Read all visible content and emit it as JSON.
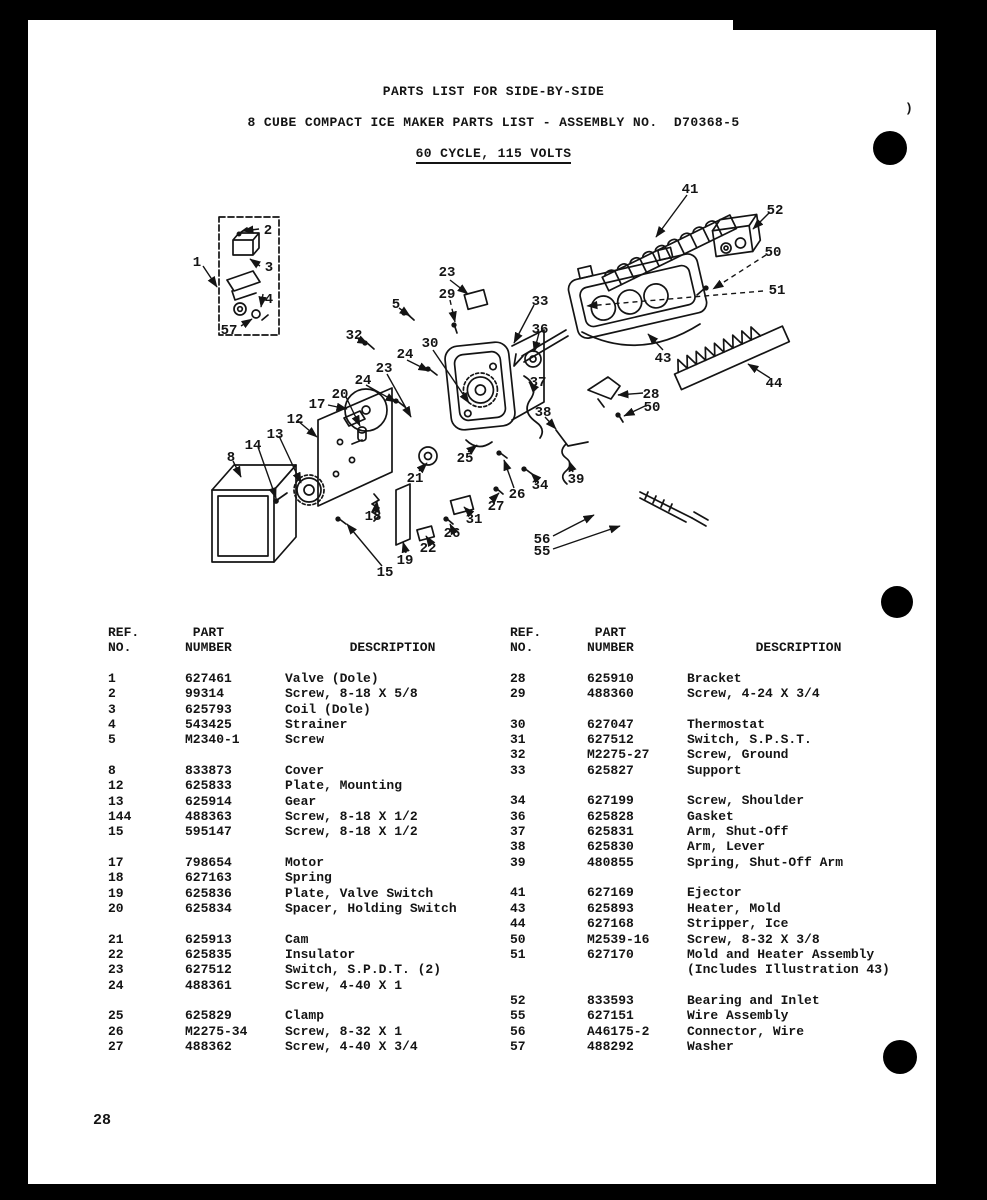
{
  "header": {
    "line1": "PARTS LIST FOR SIDE-BY-SIDE",
    "line2": "8 CUBE COMPACT ICE MAKER PARTS LIST - ASSEMBLY NO.  D70368-5",
    "line3": "60 CYCLE, 115 VOLTS"
  },
  "table": {
    "head": {
      "ref": "REF.\nNO.",
      "part": " PART\nNUMBER",
      "desc": "DESCRIPTION"
    },
    "columns": [
      {
        "groups": [
          {
            "rows": [
              [
                "1",
                "627461",
                "Valve (Dole)"
              ],
              [
                "2",
                "99314",
                "Screw, 8-18 X 5/8"
              ],
              [
                "3",
                "625793",
                "Coil (Dole)"
              ],
              [
                "4",
                "543425",
                "Strainer"
              ],
              [
                "5",
                "M2340-1",
                "Screw"
              ]
            ]
          },
          {
            "rows": [
              [
                "8",
                "833873",
                "Cover"
              ],
              [
                "12",
                "625833",
                "Plate, Mounting"
              ],
              [
                "13",
                "625914",
                "Gear"
              ],
              [
                "144",
                "488363",
                "Screw, 8-18 X 1/2"
              ],
              [
                "15",
                "595147",
                "Screw, 8-18 X 1/2"
              ]
            ]
          },
          {
            "rows": [
              [
                "17",
                "798654",
                "Motor"
              ],
              [
                "18",
                "627163",
                "Spring"
              ],
              [
                "19",
                "625836",
                "Plate, Valve Switch"
              ],
              [
                "20",
                "625834",
                "Spacer, Holding Switch"
              ]
            ]
          },
          {
            "rows": [
              [
                "21",
                "625913",
                "Cam"
              ],
              [
                "22",
                "625835",
                "Insulator"
              ],
              [
                "23",
                "627512",
                "Switch, S.P.D.T. (2)"
              ],
              [
                "24",
                "488361",
                "Screw, 4-40 X 1"
              ]
            ]
          },
          {
            "rows": [
              [
                "25",
                "625829",
                "Clamp"
              ],
              [
                "26",
                "M2275-34",
                "Screw, 8-32 X 1"
              ],
              [
                "27",
                "488362",
                "Screw, 4-40 X 3/4"
              ]
            ]
          }
        ]
      },
      {
        "groups": [
          {
            "rows": [
              [
                "28",
                "625910",
                "Bracket"
              ],
              [
                "29",
                "488360",
                "Screw, 4-24 X 3/4"
              ]
            ]
          },
          {
            "rows": [
              [
                "30",
                "627047",
                "Thermostat"
              ],
              [
                "31",
                "627512",
                "Switch, S.P.S.T."
              ],
              [
                "32",
                "M2275-27",
                "Screw, Ground"
              ],
              [
                "33",
                "625827",
                "Support"
              ]
            ]
          },
          {
            "rows": [
              [
                "34",
                "627199",
                "Screw, Shoulder"
              ],
              [
                "36",
                "625828",
                "Gasket"
              ],
              [
                "37",
                "625831",
                "Arm, Shut-Off"
              ],
              [
                "38",
                "625830",
                "Arm, Lever"
              ],
              [
                "39",
                "480855",
                "Spring, Shut-Off Arm"
              ]
            ]
          },
          {
            "rows": [
              [
                "41",
                "627169",
                "Ejector"
              ],
              [
                "43",
                "625893",
                "Heater, Mold"
              ],
              [
                "44",
                "627168",
                "Stripper, Ice"
              ],
              [
                "50",
                "M2539-16",
                "Screw, 8-32 X 3/8"
              ],
              [
                "51",
                "627170",
                "Mold and Heater Assembly",
                "(Includes Illustration 43)"
              ]
            ]
          },
          {
            "rows": [
              [
                "52",
                "833593",
                "Bearing and Inlet"
              ],
              [
                "55",
                "627151",
                "Wire Assembly"
              ],
              [
                "56",
                "A46175-2",
                "Connector, Wire"
              ],
              [
                "57",
                "488292",
                "Washer"
              ]
            ]
          }
        ]
      }
    ]
  },
  "diagram": {
    "callouts": [
      {
        "t": "1",
        "x": 197,
        "y": 261
      },
      {
        "t": "2",
        "x": 268,
        "y": 229
      },
      {
        "t": "3",
        "x": 269,
        "y": 266
      },
      {
        "t": "4",
        "x": 269,
        "y": 298
      },
      {
        "t": "57",
        "x": 229,
        "y": 329
      },
      {
        "t": "5",
        "x": 396,
        "y": 303
      },
      {
        "t": "23",
        "x": 447,
        "y": 271
      },
      {
        "t": "29",
        "x": 447,
        "y": 293
      },
      {
        "t": "32",
        "x": 354,
        "y": 334
      },
      {
        "t": "30",
        "x": 430,
        "y": 342
      },
      {
        "t": "24",
        "x": 405,
        "y": 353
      },
      {
        "t": "23",
        "x": 384,
        "y": 367
      },
      {
        "t": "24",
        "x": 363,
        "y": 379
      },
      {
        "t": "33",
        "x": 540,
        "y": 300
      },
      {
        "t": "36",
        "x": 540,
        "y": 328
      },
      {
        "t": "37",
        "x": 538,
        "y": 381
      },
      {
        "t": "38",
        "x": 543,
        "y": 411
      },
      {
        "t": "41",
        "x": 690,
        "y": 188
      },
      {
        "t": "52",
        "x": 775,
        "y": 209
      },
      {
        "t": "50",
        "x": 773,
        "y": 251
      },
      {
        "t": "51",
        "x": 777,
        "y": 289
      },
      {
        "t": "43",
        "x": 663,
        "y": 357
      },
      {
        "t": "44",
        "x": 774,
        "y": 382
      },
      {
        "t": "28",
        "x": 651,
        "y": 393
      },
      {
        "t": "50",
        "x": 652,
        "y": 406
      },
      {
        "t": "17",
        "x": 317,
        "y": 403
      },
      {
        "t": "20",
        "x": 340,
        "y": 393
      },
      {
        "t": "12",
        "x": 295,
        "y": 418
      },
      {
        "t": "13",
        "x": 275,
        "y": 433
      },
      {
        "t": "14",
        "x": 253,
        "y": 444
      },
      {
        "t": "8",
        "x": 231,
        "y": 456
      },
      {
        "t": "25",
        "x": 465,
        "y": 457
      },
      {
        "t": "21",
        "x": 415,
        "y": 477
      },
      {
        "t": "34",
        "x": 540,
        "y": 484
      },
      {
        "t": "39",
        "x": 576,
        "y": 478
      },
      {
        "t": "26",
        "x": 517,
        "y": 493
      },
      {
        "t": "27",
        "x": 496,
        "y": 505
      },
      {
        "t": "31",
        "x": 474,
        "y": 518
      },
      {
        "t": "18",
        "x": 373,
        "y": 515
      },
      {
        "t": "26",
        "x": 452,
        "y": 532
      },
      {
        "t": "22",
        "x": 428,
        "y": 547
      },
      {
        "t": "19",
        "x": 405,
        "y": 559
      },
      {
        "t": "15",
        "x": 385,
        "y": 571
      },
      {
        "t": "56",
        "x": 542,
        "y": 538
      },
      {
        "t": "55",
        "x": 542,
        "y": 550
      }
    ]
  },
  "page": {
    "number": "28",
    "stray_mark": ")"
  },
  "colors": {
    "ink": "#141414",
    "paper": "#ffffff",
    "scan_black": "#000000"
  }
}
